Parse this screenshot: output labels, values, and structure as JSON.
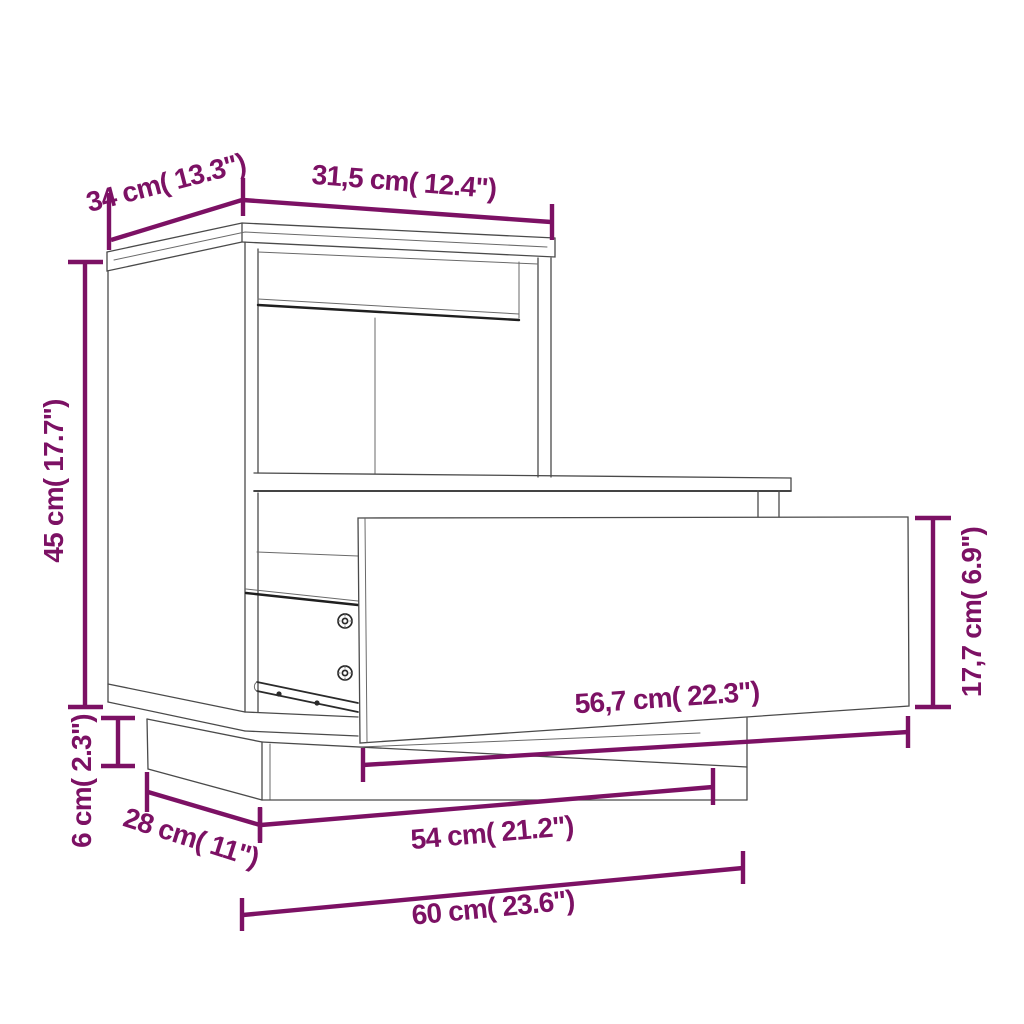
{
  "diagram": {
    "name": "bedside-cabinet-dimension-diagram",
    "background_color": "#ffffff",
    "accent_color": "#7c1164",
    "line_color": "#4a4a4a",
    "dimensions": {
      "top_depth": "34 cm( 13.3\")",
      "top_width": "31,5 cm( 12.4\")",
      "height": "45 cm( 17.7\")",
      "plinth_height": "6 cm( 2.3\")",
      "base_depth": "28 cm( 11\")",
      "plinth_width": "54 cm( 21.2\")",
      "total_width": "60 cm( 23.6\")",
      "drawer_width": "56,7 cm( 22.3\")",
      "drawer_height": "17,7 cm( 6.9\")"
    }
  }
}
